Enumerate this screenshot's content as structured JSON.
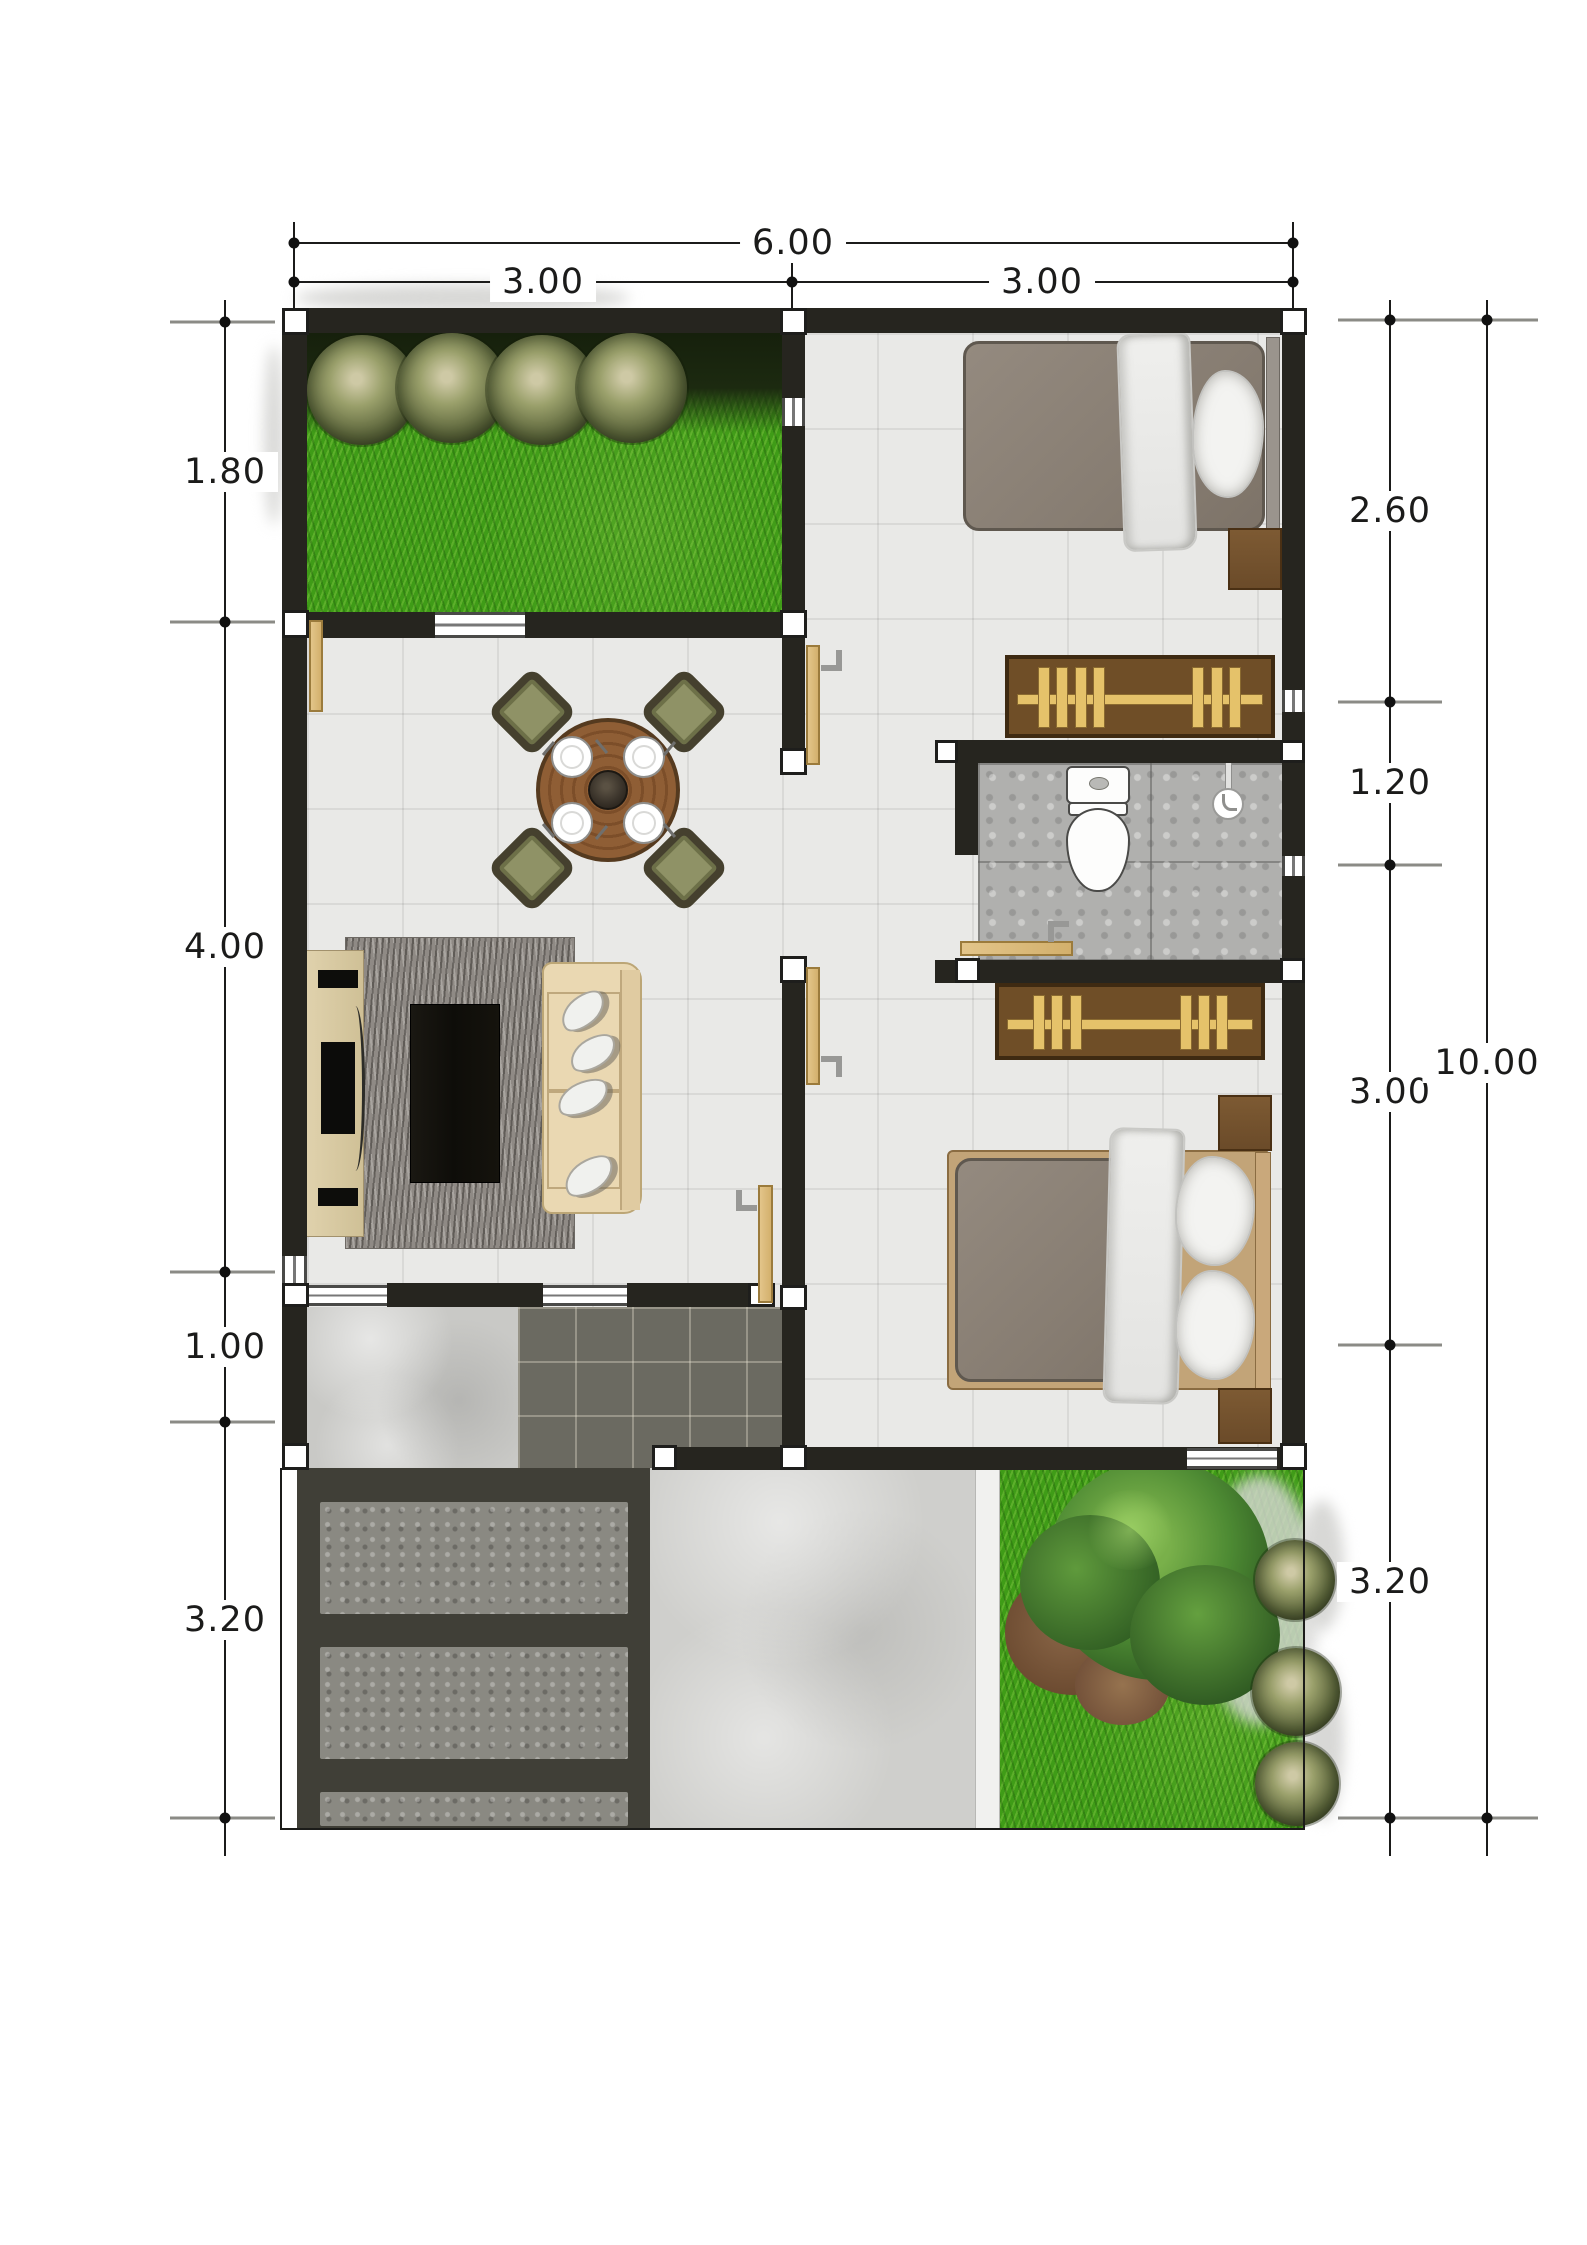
{
  "plan": {
    "type": "architectural-floor-plan",
    "dimensions": {
      "top": {
        "total": "6.00",
        "segments": [
          "3.00",
          "3.00"
        ]
      },
      "left": {
        "segments": [
          "1.80",
          "4.00",
          "1.00",
          "3.20"
        ]
      },
      "right": {
        "segments": [
          "2.60",
          "1.20",
          "3.00",
          "3.20"
        ],
        "total": "10.00"
      }
    },
    "colors": {
      "wall": "#26251f",
      "floor_tile": "#e9e9e7",
      "grass": "#3f9c17",
      "bathroom_floor": "#b0b0ae",
      "door_wood": "#ddbe7e",
      "wardrobe_wood": "#6f4e27",
      "hanger_tan": "#e5c26a",
      "carport_slab": "#403f37",
      "carport_pad": "#8a8982",
      "terrace_tile": "#6b6a61",
      "concrete": "#c9c9c6",
      "sofa_cream": "#ead8b2",
      "bed_mattress": "#8e8277",
      "bedding_white": "#ebebe9",
      "dining_wood": "#91603a",
      "chair_olive": "#8f9266",
      "rug": "#8f8a85",
      "dimension_line": "#1b1b1a"
    },
    "rooms": {
      "front_garden": {
        "icons": [
          "lawn",
          "shrub-icon",
          "shrub-icon",
          "shrub-icon",
          "shrub-icon"
        ]
      },
      "bedroom_1": {
        "icons": [
          "bed-icon",
          "pillow-icon",
          "nightstand-icon",
          "wardrobe-icon",
          "door-icon"
        ]
      },
      "bathroom": {
        "icons": [
          "toilet-icon",
          "hand-shower-icon",
          "door-icon"
        ]
      },
      "bedroom_2": {
        "icons": [
          "bed-icon",
          "pillow-icon",
          "nightstand-icon",
          "nightstand-icon",
          "wardrobe-icon",
          "door-icon"
        ]
      },
      "living_dining": {
        "icons": [
          "dining-table-icon",
          "chair-icon",
          "chair-icon",
          "chair-icon",
          "chair-icon",
          "sofa-icon",
          "coffee-table-icon",
          "tv-console-icon",
          "rug-icon",
          "door-icon"
        ]
      },
      "terrace": {
        "icons": [
          "dark-tile-paving"
        ]
      },
      "carport": {
        "icons": [
          "paving-pad",
          "paving-pad",
          "paving-pad"
        ]
      },
      "back_garden": {
        "icons": [
          "lawn",
          "tree-icon",
          "shrub-icon",
          "shrub-icon",
          "shrub-icon"
        ]
      },
      "side_path": {
        "icons": [
          "concrete-path"
        ]
      }
    }
  }
}
